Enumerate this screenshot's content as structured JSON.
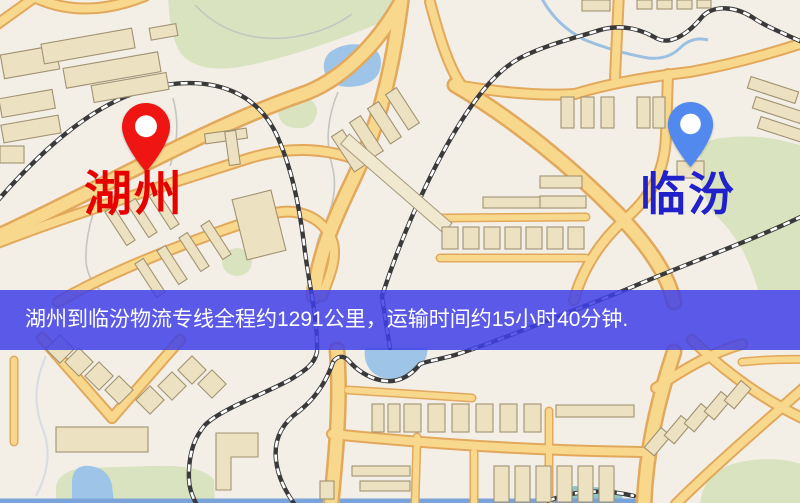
{
  "theme": {
    "origin_pin_color": "#ee1512",
    "destination_pin_color": "#5189ee",
    "origin_label_color": "#e60000",
    "destination_label_color": "#2121cc",
    "banner_bg_color": "#4040e8",
    "banner_text_color": "#ffffff"
  },
  "map": {
    "origin": {
      "name": "湖州"
    },
    "destination": {
      "name": "临汾"
    },
    "banner": {
      "text": "湖州到临汾物流专线全程约1291公里，运输时间约15小时40分钟."
    }
  }
}
